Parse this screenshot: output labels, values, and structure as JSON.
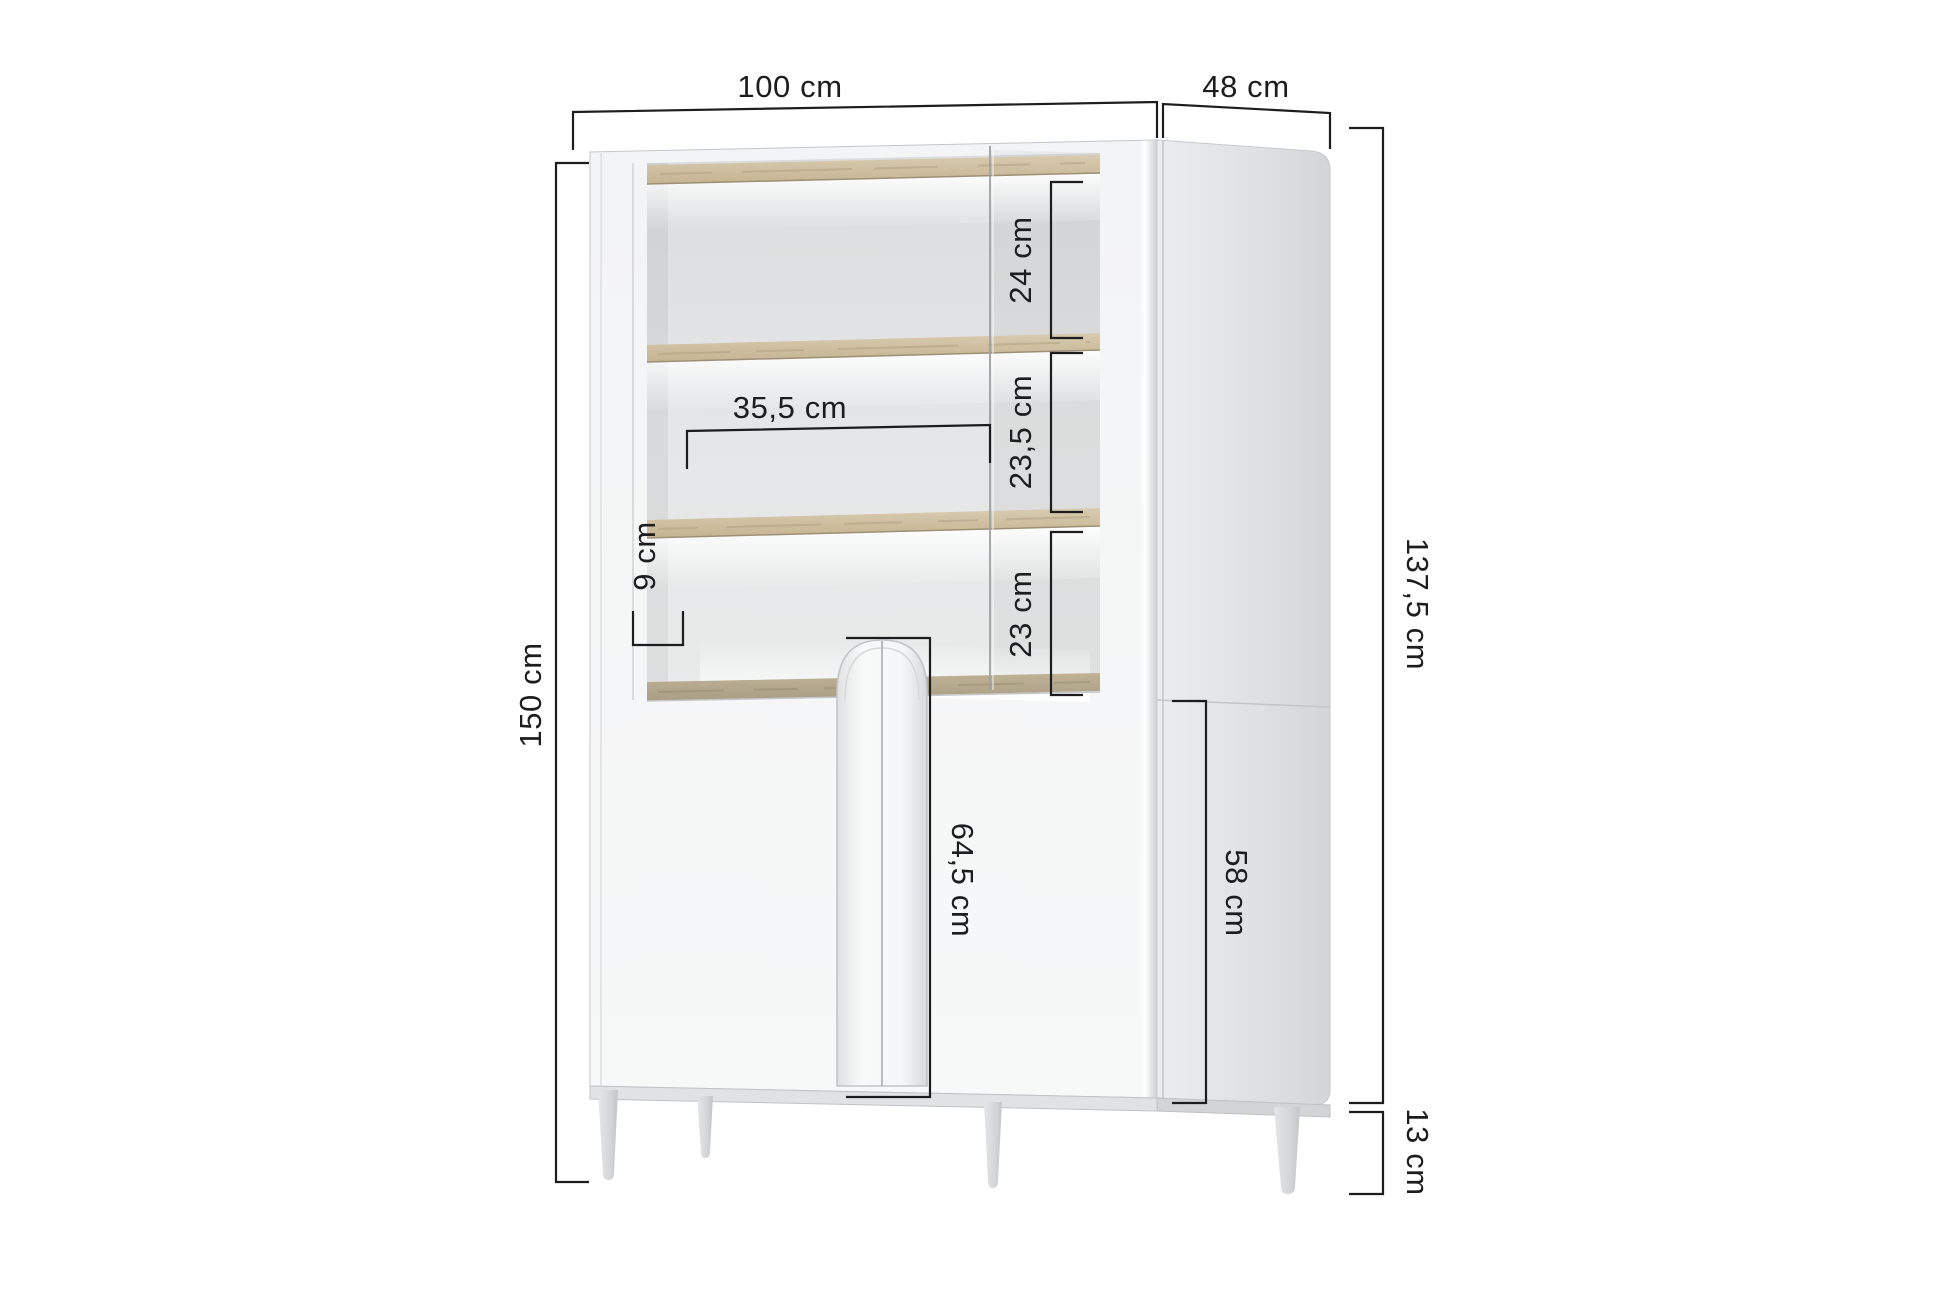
{
  "diagram": {
    "type": "furniture-dimension-diagram",
    "labels": {
      "overall_width": "100 cm",
      "overall_depth": "48 cm",
      "overall_height": "150 cm",
      "body_height": "137,5 cm",
      "leg_height": "13 cm",
      "top_shelf_space": "24 cm",
      "middle_shelf_space": "23,5 cm",
      "bottom_shelf_space": "23 cm",
      "inner_shelf_width": "35,5 cm",
      "side_frame_width": "9 cm",
      "door_front_height": "64,5 cm",
      "lower_cabinet_side_height": "58 cm"
    },
    "colors": {
      "dimension_lines": "#1d1d1f",
      "cabinet_body": "#f4f5f6",
      "cabinet_side": "#dcdee0",
      "wood_shelf": "#cfc0a4"
    }
  }
}
